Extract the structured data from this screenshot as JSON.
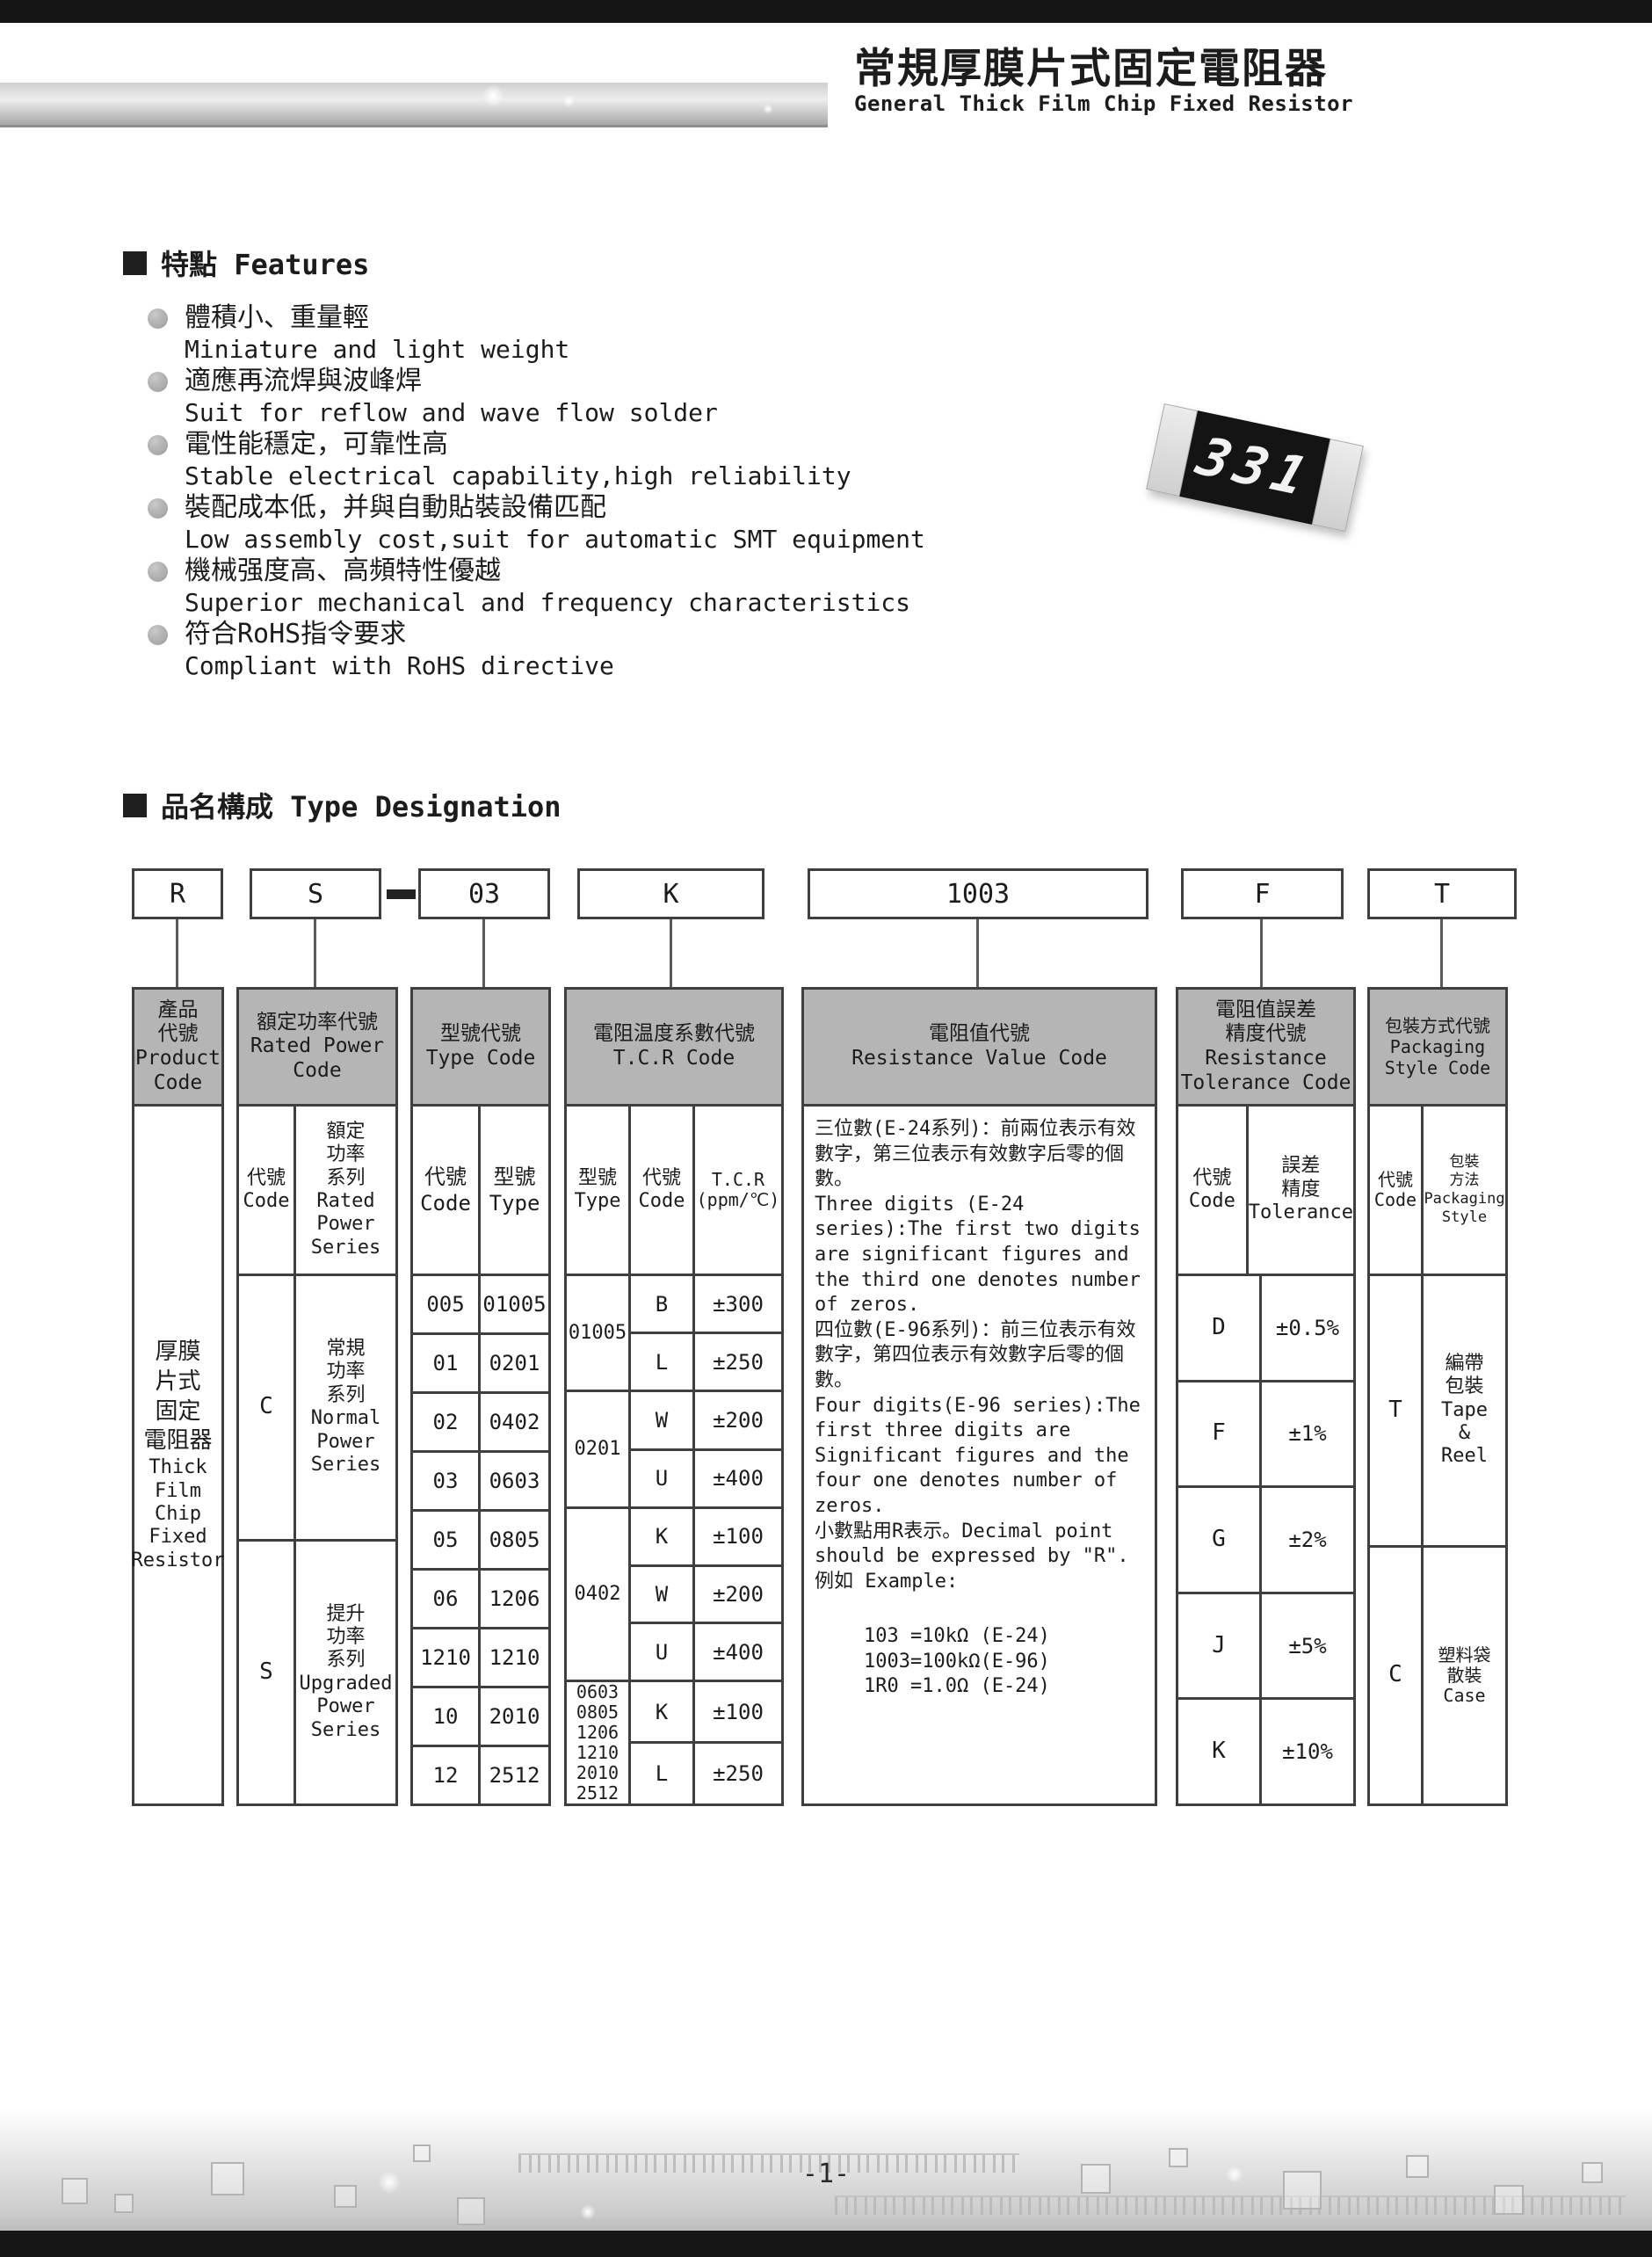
{
  "page": {
    "page_number": "-1-"
  },
  "header": {
    "title_zh": "常規厚膜片式固定電阻器",
    "title_en": "General Thick Film Chip Fixed Resistor"
  },
  "features": {
    "heading": "特點 Features",
    "items": [
      {
        "zh": "體積小、重量輕",
        "en": "Miniature and light weight"
      },
      {
        "zh": "適應再流焊與波峰焊",
        "en": "Suit for reflow and wave flow solder"
      },
      {
        "zh": "電性能穩定，可靠性高",
        "en": "Stable electrical capability,high reliability"
      },
      {
        "zh": "裝配成本低，并與自動貼裝設備匹配",
        "en": "Low assembly cost,suit for automatic SMT equipment"
      },
      {
        "zh": "機械强度高、高頻特性優越",
        "en": "Superior mechanical and frequency characteristics"
      },
      {
        "zh": "符合RoHS指令要求",
        "en": "Compliant with RoHS directive"
      }
    ],
    "chip_marking": "331"
  },
  "type_designation": {
    "heading": "品名構成  Type Designation",
    "code_boxes": {
      "product": "R",
      "power": "S",
      "type": "03",
      "tcr": "K",
      "value": "1003",
      "tolerance": "F",
      "packaging": "T"
    },
    "product_col": {
      "header": "產品\n代號\nProduct\nCode",
      "body_zh": "厚膜\n片式\n固定\n電阻器",
      "body_en": "Thick\nFilm\nChip\nFixed\nResistor"
    },
    "power_col": {
      "header": "額定功率代號\nRated Power\nCode",
      "sub_code": "代號\nCode",
      "sub_series": "額定\n功率\n系列\nRated\nPower\nSeries",
      "rows": [
        {
          "code": "C",
          "series": "常規\n功率\n系列\nNormal\nPower\nSeries"
        },
        {
          "code": "S",
          "series": "提升\n功率\n系列\nUpgraded\nPower\nSeries"
        }
      ]
    },
    "type_col": {
      "header": "型號代號\nType Code",
      "sub_code": "代號\nCode",
      "sub_type": "型號\nType",
      "rows": [
        {
          "code": "005",
          "type": "01005"
        },
        {
          "code": "01",
          "type": "0201"
        },
        {
          "code": "02",
          "type": "0402"
        },
        {
          "code": "03",
          "type": "0603"
        },
        {
          "code": "05",
          "type": "0805"
        },
        {
          "code": "06",
          "type": "1206"
        },
        {
          "code": "1210",
          "type": "1210"
        },
        {
          "code": "10",
          "type": "2010"
        },
        {
          "code": "12",
          "type": "2512"
        }
      ]
    },
    "tcr_col": {
      "header": "電阻温度系數代號\nT.C.R Code",
      "sub_type": "型號\nType",
      "sub_code": "代號\nCode",
      "sub_val": "T.C.R\n(ppm/℃)",
      "groups": [
        {
          "type": "01005",
          "rows": [
            {
              "code": "B",
              "val": "±300"
            },
            {
              "code": "L",
              "val": "±250"
            }
          ]
        },
        {
          "type": "0201",
          "rows": [
            {
              "code": "W",
              "val": "±200"
            },
            {
              "code": "U",
              "val": "±400"
            }
          ]
        },
        {
          "type": "0402",
          "rows": [
            {
              "code": "K",
              "val": "±100"
            },
            {
              "code": "W",
              "val": "±200"
            },
            {
              "code": "U",
              "val": "±400"
            }
          ]
        },
        {
          "type": "0603\n0805\n1206\n1210\n2010\n2512",
          "rows": [
            {
              "code": "K",
              "val": "±100"
            },
            {
              "code": "L",
              "val": "±250"
            }
          ]
        }
      ]
    },
    "value_col": {
      "header": "電阻值代號\nResistance Value Code",
      "paragraphs": [
        "三位數(E-24系列)：前兩位表示有效數字，第三位表示有效數字后零的個數。",
        "Three digits (E-24 series):The first two digits are significant figures and the third one denotes number of zeros.",
        "四位數(E-96系列)：前三位表示有效數字，第四位表示有效數字后零的個數。",
        "Four digits(E-96 series):The first three digits are Significant figures and the four one denotes number of zeros.",
        "小數點用R表示。Decimal point should be expressed by \"R\".",
        "例如 Example:"
      ],
      "examples": "103 =10kΩ (E-24)\n1003=100kΩ(E-96)\n1R0 =1.0Ω (E-24)"
    },
    "tolerance_col": {
      "header": "電阻值誤差\n精度代號\nResistance\nTolerance Code",
      "sub_code": "代號\nCode",
      "sub_tol": "誤差\n精度\nTolerance",
      "rows": [
        {
          "code": "D",
          "tol": "±0.5%"
        },
        {
          "code": "F",
          "tol": "±1%"
        },
        {
          "code": "G",
          "tol": "±2%"
        },
        {
          "code": "J",
          "tol": "±5%"
        },
        {
          "code": "K",
          "tol": "±10%"
        }
      ]
    },
    "packaging_col": {
      "header": "包裝方式代號\nPackaging\nStyle Code",
      "sub_code": "代號\nCode",
      "sub_style": "包裝\n方法\nPackaging\nStyle",
      "rows": [
        {
          "code": "T",
          "style": "編帶\n包裝\nTape\n&\nReel"
        },
        {
          "code": "C",
          "style": "塑料袋\n散裝\nCase"
        }
      ]
    }
  }
}
